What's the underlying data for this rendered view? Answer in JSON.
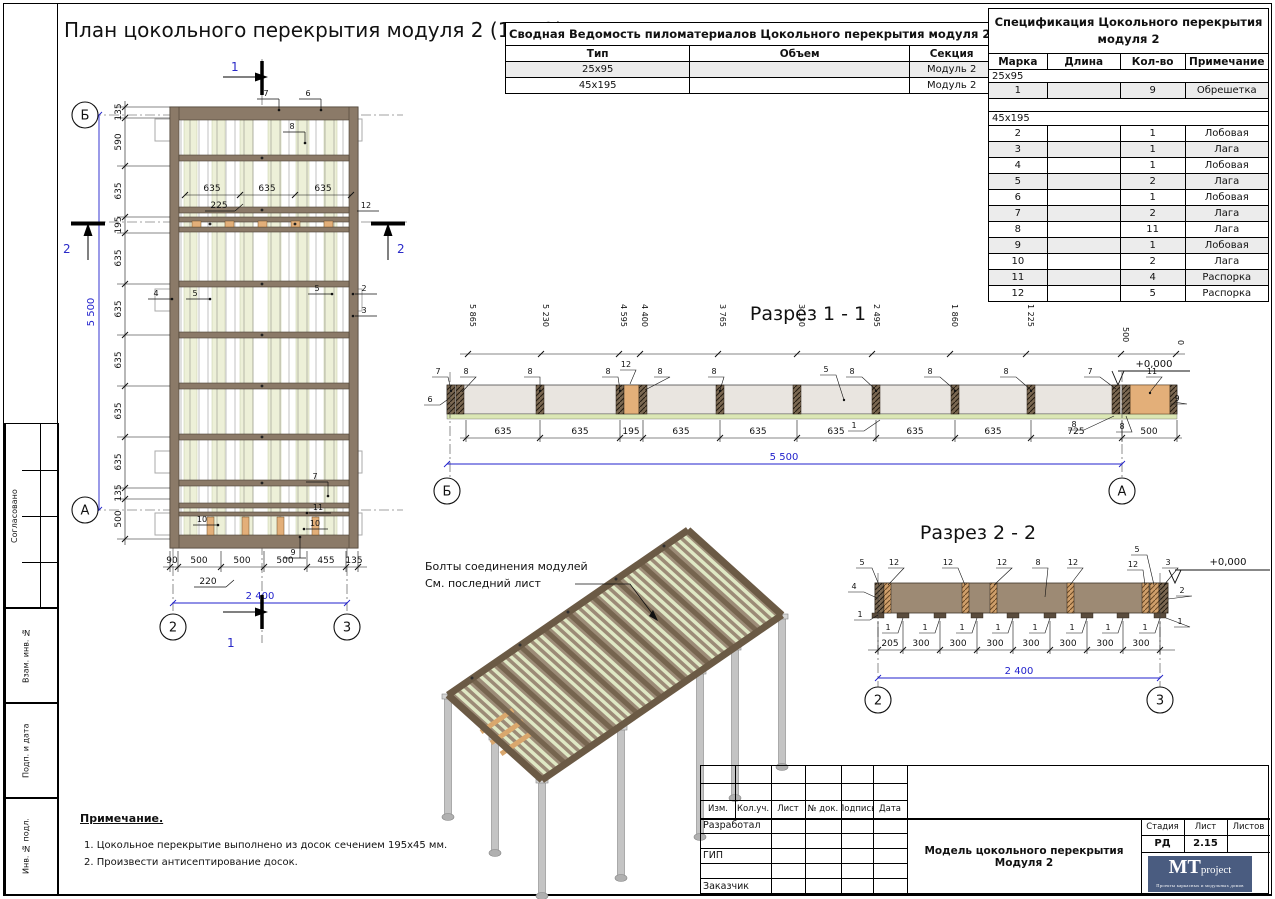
{
  "page": {
    "title": "План цокольного перекрытия модуля 2 (1 : 42)"
  },
  "colors": {
    "dim_blue": "#2222cc",
    "wood_brown": "#8b7a68",
    "board_green": "#edf0d8",
    "slab_gray": "#e9e5e0",
    "accent_orange": "#e3af79",
    "section2_body": "#9d8a74",
    "logo_bg": "#4a5c80",
    "row_shade": "#ececec"
  },
  "lumber_table": {
    "title": "Сводная Ведомость пиломатериалов Цокольного перекрытия модуля 2",
    "headers": [
      "Тип",
      "Объем",
      "Секция"
    ],
    "rows": [
      {
        "type": "25х95",
        "volume": "",
        "section": "Модуль 2"
      },
      {
        "type": "45х195",
        "volume": "",
        "section": "Модуль 2"
      }
    ]
  },
  "spec_table": {
    "title_line1": "Спецификация Цокольного перекрытия",
    "title_line2": "модуля 2",
    "headers": [
      "Марка",
      "Длина",
      "Кол-во",
      "Примечание"
    ],
    "group1": "25х95",
    "group2": "45х195",
    "rows_g1": [
      {
        "mark": "1",
        "len": "",
        "qty": "9",
        "note": "Обрешетка"
      }
    ],
    "rows_g2": [
      {
        "mark": "2",
        "len": "",
        "qty": "1",
        "note": "Лобовая"
      },
      {
        "mark": "3",
        "len": "",
        "qty": "1",
        "note": "Лага"
      },
      {
        "mark": "4",
        "len": "",
        "qty": "1",
        "note": "Лобовая"
      },
      {
        "mark": "5",
        "len": "",
        "qty": "2",
        "note": "Лага"
      },
      {
        "mark": "6",
        "len": "",
        "qty": "1",
        "note": "Лобовая"
      },
      {
        "mark": "7",
        "len": "",
        "qty": "2",
        "note": "Лага"
      },
      {
        "mark": "8",
        "len": "",
        "qty": "11",
        "note": "Лага"
      },
      {
        "mark": "9",
        "len": "",
        "qty": "1",
        "note": "Лобовая"
      },
      {
        "mark": "10",
        "len": "",
        "qty": "2",
        "note": "Лага"
      },
      {
        "mark": "11",
        "len": "",
        "qty": "4",
        "note": "Распорка"
      },
      {
        "mark": "12",
        "len": "",
        "qty": "5",
        "note": "Распорка"
      }
    ]
  },
  "plan": {
    "left_dims": [
      "135",
      "590",
      "635",
      "195",
      "635",
      "635",
      "635",
      "635",
      "635",
      "135",
      "500"
    ],
    "left_total": "5 500",
    "inner_dims": [
      "635",
      "635",
      "635"
    ],
    "inner_sub": "225",
    "bottom_dims": [
      "90",
      "500",
      "500",
      "500",
      "455",
      "135"
    ],
    "bottom_sub": "220",
    "bottom_total": "2 400",
    "axis_top": "Б",
    "axis_bottom": "А",
    "col_left": "2",
    "col_right": "3",
    "cut1": "1",
    "cut2": "2",
    "p2": "2",
    "p3": "3",
    "p4": "4",
    "p5": "5",
    "p6": "6",
    "p7": "7",
    "p8": "8",
    "p9": "9",
    "p10": "10",
    "p11": "11",
    "p12": "12"
  },
  "section1": {
    "title": "Разрез 1 - 1",
    "top_dims": [
      "5 865",
      "5 230",
      "4 595",
      "4 400",
      "3 765",
      "3 130",
      "2 495",
      "1 860",
      "1 225",
      "500",
      "0"
    ],
    "bottom_dims": [
      "635",
      "635",
      "195",
      "635",
      "635",
      "635",
      "635",
      "635",
      "725",
      "500"
    ],
    "total": "5 500",
    "axis_left": "Б",
    "axis_right": "А",
    "elev": "+0,000",
    "l1": "1",
    "l5": "5",
    "l6": "6",
    "l7": "7",
    "l8": "8",
    "l9": "9",
    "l11": "11",
    "l12": "12"
  },
  "section2": {
    "title": "Разрез 2 - 2",
    "dims": [
      "205",
      "300",
      "300",
      "300",
      "300",
      "300",
      "300",
      "300"
    ],
    "total": "2 400",
    "col_left": "2",
    "col_right": "3",
    "elev": "+0,000",
    "l1": "1",
    "l2": "2",
    "l3": "3",
    "l4": "4",
    "l5": "5",
    "l8": "8",
    "l12": "12"
  },
  "iso": {
    "callout_line1": "Болты соединения модулей",
    "callout_line2": "См. последний лист"
  },
  "notes": {
    "title": "Примечание.",
    "n1": "1.   Цокольное перекрытие выполнено из досок сечением 195х45 мм.",
    "n2": "2.   Произвести антисептирование досок."
  },
  "titleblock": {
    "cols": [
      "Изм.",
      "Кол.уч.",
      "Лист",
      "№ док.",
      "Подпись",
      "Дата"
    ],
    "row_developed": "Разработал",
    "row_gip": "ГИП",
    "row_customer": "Заказчик",
    "doc_title": "Модель цокольного перекрытия Модуля 2",
    "stage_h": [
      "Стадия",
      "Лист",
      "Листов"
    ],
    "stage_val": "РД",
    "sheet_val": "2.15",
    "logo_mt": "MT",
    "logo_project": "project",
    "logo_tagline": "Проекты каркасных и модульных домов"
  },
  "stamp": {
    "approved": "Согласовано",
    "vzam": "Взам. инв. №",
    "podp": "Подп. и дата",
    "inv": "Инв. № подл."
  }
}
